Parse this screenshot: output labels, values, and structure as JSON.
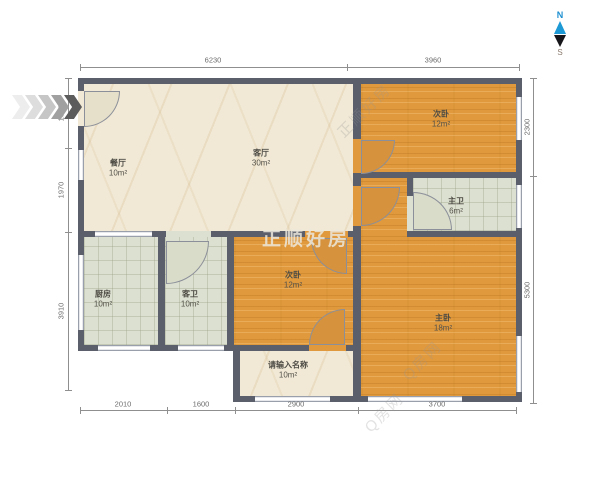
{
  "compass": {
    "north": "N",
    "south": "S"
  },
  "rooms": [
    {
      "name": "餐厅",
      "area": "10m²"
    },
    {
      "name": "客厅",
      "area": "30m²"
    },
    {
      "name": "次卧",
      "area": "12m²"
    },
    {
      "name": "主卫",
      "area": "6m²"
    },
    {
      "name": "厨房",
      "area": "10m²"
    },
    {
      "name": "客卫",
      "area": "10m²"
    },
    {
      "name": "次卧",
      "area": "12m²"
    },
    {
      "name": "主卧",
      "area": "18m²"
    },
    {
      "name": "请输入名称",
      "area": "10m²"
    }
  ],
  "dimensions": {
    "top": [
      "6230",
      "3960"
    ],
    "bottom": [
      "2010",
      "1600",
      "2900",
      "3700"
    ],
    "left": [
      "1320",
      "1970",
      "3910"
    ],
    "right": [
      "2300",
      "5300"
    ]
  },
  "watermarks": {
    "brand_center": "正顺好房",
    "brand_diagonal": "正顺好房",
    "site_diagonal": "Q房网",
    "site_diagonal2": "Q房网"
  },
  "colors": {
    "wall": "#5a5f6b",
    "wood_floor": "#e0993d",
    "tile_floor": "#dce0d0",
    "marble_floor": "#f1e9d6",
    "compass_north": "#1d99d5"
  }
}
